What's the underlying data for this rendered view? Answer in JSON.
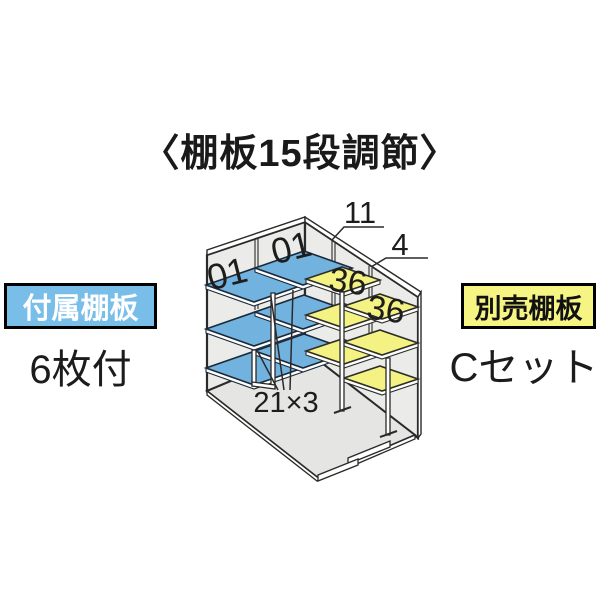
{
  "title": "〈棚板15段調節〉",
  "left_annotation": {
    "label": "付属棚板",
    "sub": "6枚付"
  },
  "right_annotation": {
    "label": "別売棚板",
    "sub": "Cセット"
  },
  "diagram": {
    "label_01_left": "01",
    "label_01_right": "01",
    "label_11": "11",
    "label_4": "4",
    "label_36_upper": "36",
    "label_36_lower": "36",
    "label_21x3": "21×3"
  },
  "colors": {
    "included_shelf_blue": "#72B2DF",
    "optional_shelf_yellow": "#F4F282",
    "wall_gray": "#EBEBE9",
    "floor_gray": "#E5E5E3",
    "badge_blue_bg": "#79BEE9",
    "badge_yellow_bg": "#F6F584",
    "line_dark": "#2a2a2a"
  }
}
